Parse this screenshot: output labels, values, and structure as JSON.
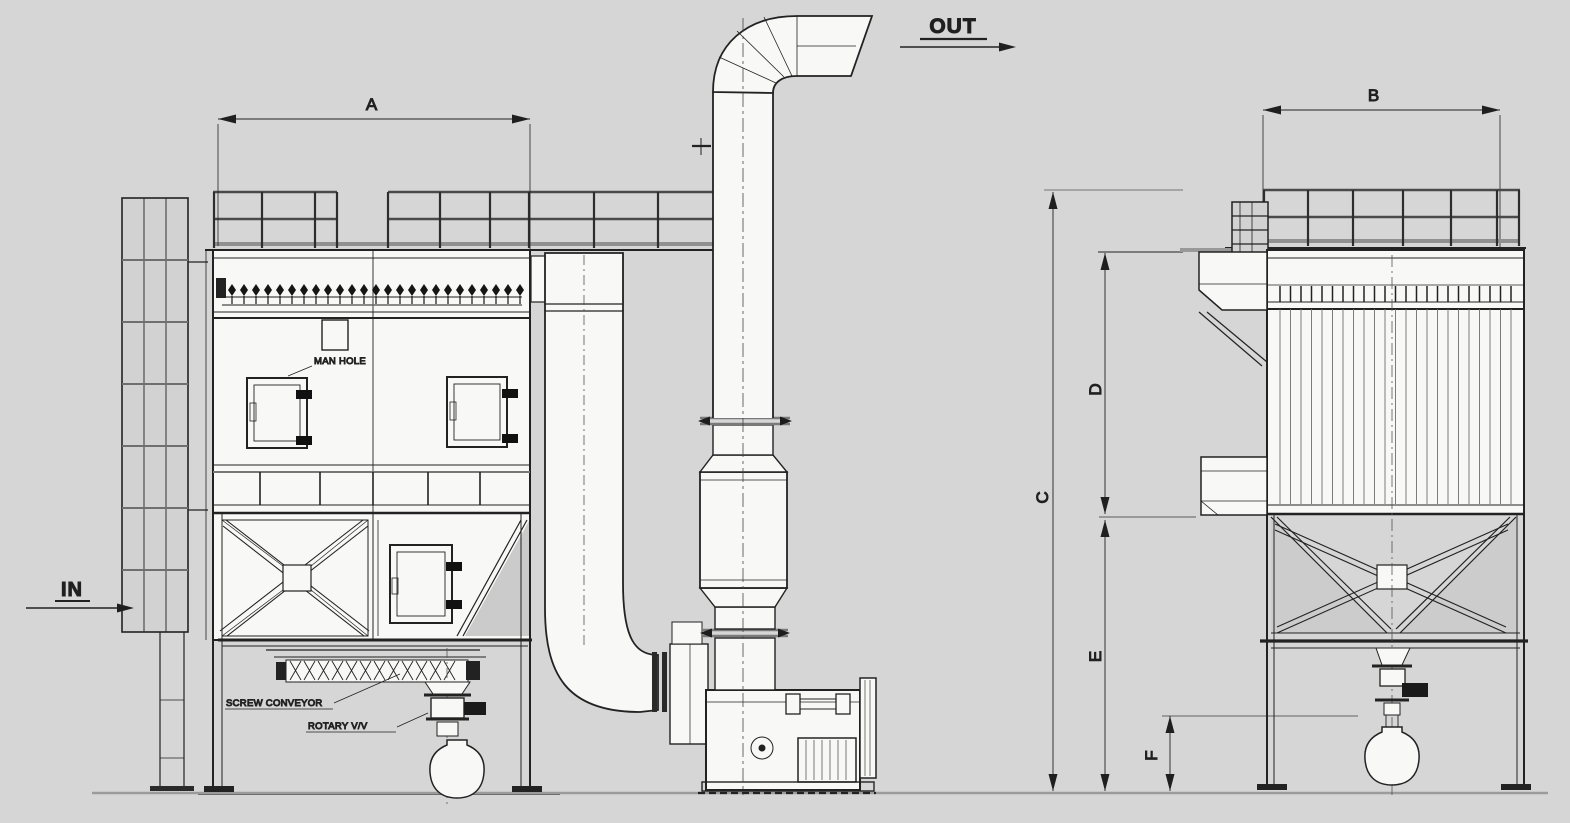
{
  "colors": {
    "background": "#d6d6d7",
    "ink": "#1f1f1f",
    "structure_gray": "#8e8e8e",
    "panel_white": "#f8f8f7"
  },
  "flow_labels": {
    "inlet": "IN",
    "outlet": "OUT"
  },
  "dimension_labels": {
    "a": "A",
    "b": "B",
    "c": "C",
    "d": "D",
    "e": "E",
    "f": "F"
  },
  "callouts": {
    "man_hole": "MAN HOLE",
    "screw_conveyor": "SCREW CONVEYOR",
    "rotary_valve": "ROTARY V/V"
  }
}
